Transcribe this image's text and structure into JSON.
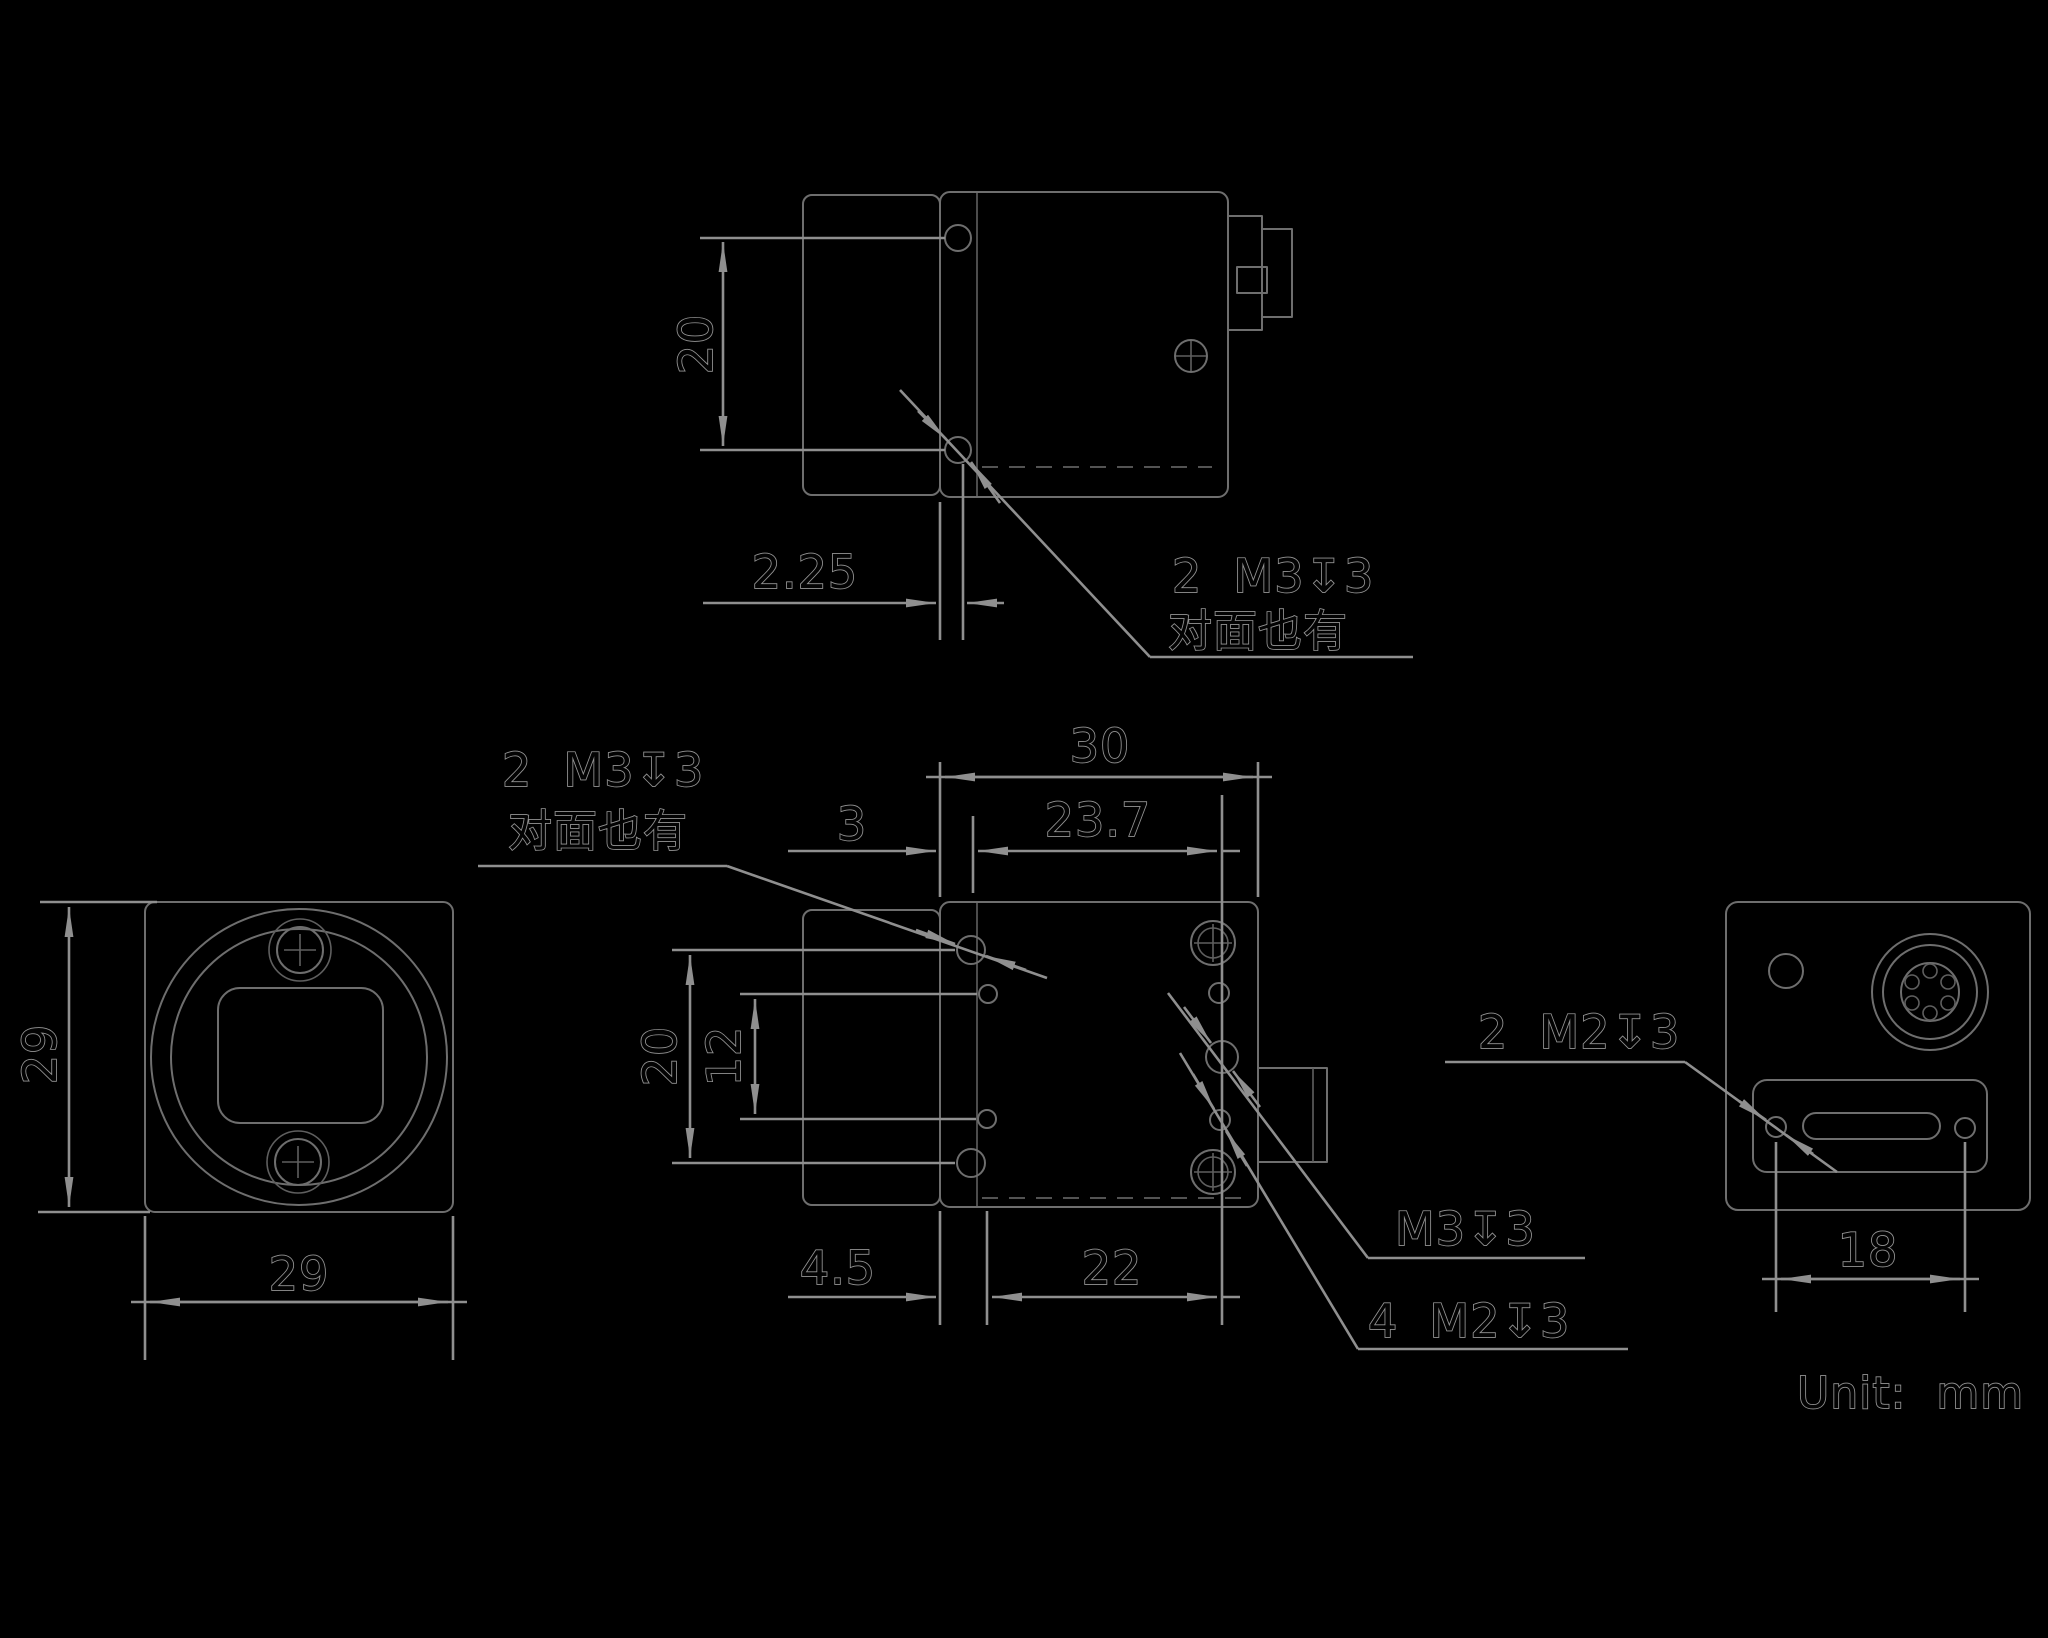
{
  "drawing": {
    "title": "camera-dimension-drawing",
    "unit_label": "Unit:  mm",
    "colors": {
      "background": "#000000",
      "geometry": "#6e6e6e",
      "dimension": "#8f8f8f"
    },
    "notes": {
      "top_thread": "2  M3↧3",
      "top_thread_note": "对面也有",
      "side_thread": "2  M3↧3",
      "side_thread_note": "对面也有",
      "side_m3_single": "M3↧3",
      "side_m2_group": "4  M2↧3",
      "back_m2_pair": "2  M2↧3"
    },
    "dims": {
      "top_hole_spacing": "20",
      "top_hole_offset": "2.25",
      "front_height": "29",
      "front_width": "29",
      "side_body_width": "30",
      "side_edge_to_hole": "3",
      "side_hole_span": "23.7",
      "side_hole_spacing_v": "20",
      "side_m2_spacing_v": "12",
      "side_bottom_offset": "4.5",
      "side_bottom_span": "22",
      "back_hole_span": "18"
    }
  }
}
